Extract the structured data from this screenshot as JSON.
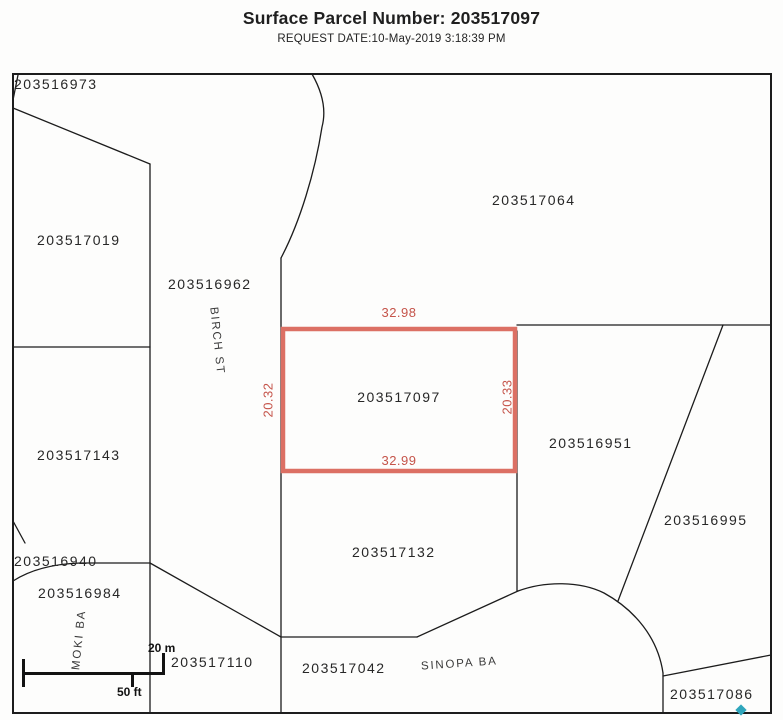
{
  "header": {
    "title": "Surface Parcel Number: 203517097",
    "request_date": "REQUEST DATE:10-May-2019 3:18:39 PM"
  },
  "map": {
    "subject_parcel": {
      "id": "203517097",
      "dim_top": "32.98",
      "dim_bottom": "32.99",
      "dim_left": "20.32",
      "dim_right": "20.33"
    },
    "parcels": [
      {
        "id": "203516973"
      },
      {
        "id": "203517019"
      },
      {
        "id": "203516962"
      },
      {
        "id": "203517064"
      },
      {
        "id": "203517143"
      },
      {
        "id": "203516951"
      },
      {
        "id": "203516995"
      },
      {
        "id": "203516940"
      },
      {
        "id": "203516984"
      },
      {
        "id": "203517132"
      },
      {
        "id": "203517110"
      },
      {
        "id": "203517042"
      },
      {
        "id": "203517086"
      }
    ],
    "streets": [
      {
        "name": "BIRCH ST"
      },
      {
        "name": "MOKI BA"
      },
      {
        "name": "SINOPA BA"
      }
    ],
    "scale": {
      "metric": "20 m",
      "imperial": "50 ft"
    },
    "colors": {
      "highlight_outline": "#dc7064",
      "dimension_text": "#c5544a",
      "boundary_line": "#1c1c1c",
      "marker": "#2fa6bc"
    }
  }
}
